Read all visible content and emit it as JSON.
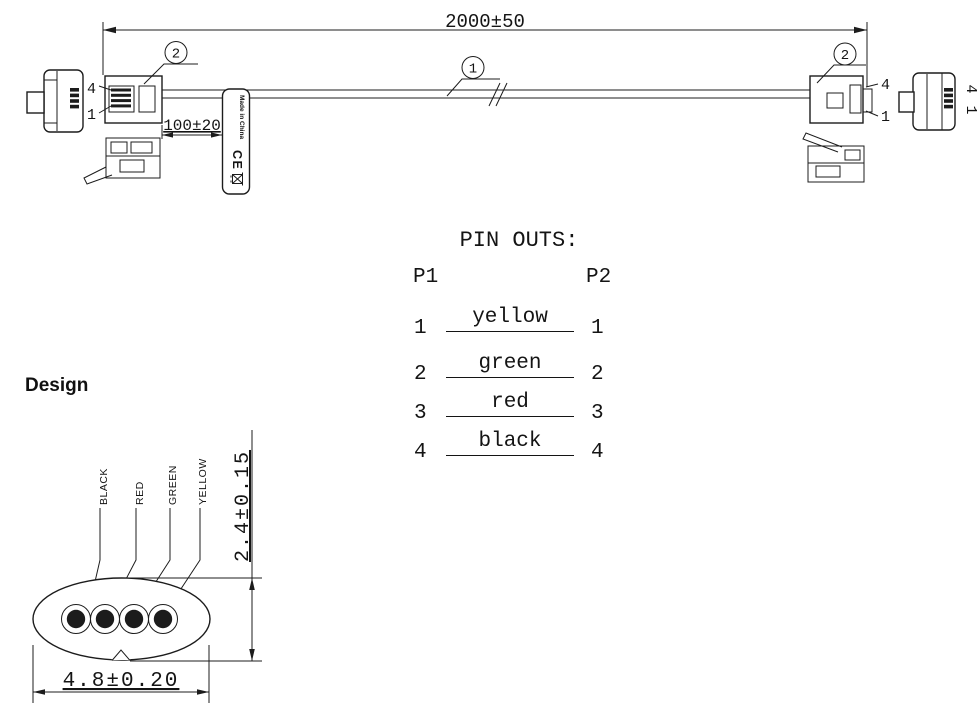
{
  "drawing": {
    "length_dim": "2000±50",
    "tail_dim": "100±20",
    "callout_cable": "1",
    "callout_connector": "2",
    "pin_top": "4",
    "pin_bottom": "1",
    "tag": {
      "text": "Made in China",
      "ce": "CE"
    }
  },
  "pinouts": {
    "title": "PIN OUTS:",
    "p1": "P1",
    "p2": "P2",
    "rows": [
      {
        "left": "1",
        "wire": "yellow",
        "right": "1"
      },
      {
        "left": "2",
        "wire": "green",
        "right": "2"
      },
      {
        "left": "3",
        "wire": "red",
        "right": "3"
      },
      {
        "left": "4",
        "wire": "black",
        "right": "4"
      }
    ]
  },
  "design": {
    "heading": "Design",
    "labels": [
      "BLACK",
      "RED",
      "GREEN",
      "YELLOW"
    ],
    "height_dim": "2.4±0.15",
    "width_dim": "4.8±0.20"
  },
  "colors": {
    "ink": "#1c1c1c",
    "background": "#ffffff"
  }
}
